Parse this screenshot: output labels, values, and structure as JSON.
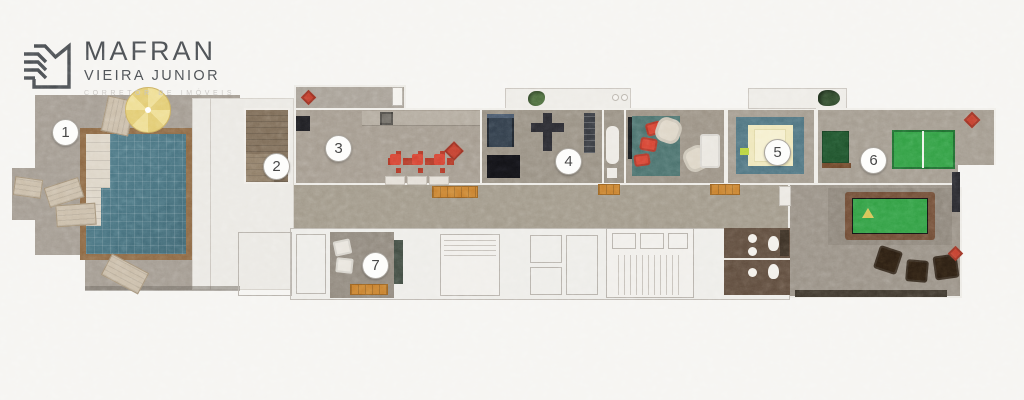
{
  "logo": {
    "title": "MAFRAN",
    "subtitle": "VIEIRA JUNIOR",
    "tagline": "CORRETOR DE IMÓVEIS"
  },
  "floorplan": {
    "markers": [
      {
        "label": "1",
        "area": "pool-terrace"
      },
      {
        "label": "2",
        "area": "wood-deck"
      },
      {
        "label": "3",
        "area": "gourmet-lounge"
      },
      {
        "label": "4",
        "area": "gym"
      },
      {
        "label": "5",
        "area": "ball-pit"
      },
      {
        "label": "6",
        "area": "game-room"
      },
      {
        "label": "7",
        "area": "lobby"
      }
    ],
    "colors": {
      "background": "#f5f4f1",
      "deck_gray": "#a29a90",
      "pool_water": "#497481",
      "pool_frame": "#8c6742",
      "wood_deck": "#7d6b56",
      "accent_red": "#d5402f",
      "accent_orange": "#c8812d",
      "table_green": "#2f9e41",
      "mat_teal": "#4d7380",
      "umbrella_yellow": "#eedd92",
      "bathroom_brown": "#5d4a3b",
      "logo_gray": "#45494d"
    }
  }
}
